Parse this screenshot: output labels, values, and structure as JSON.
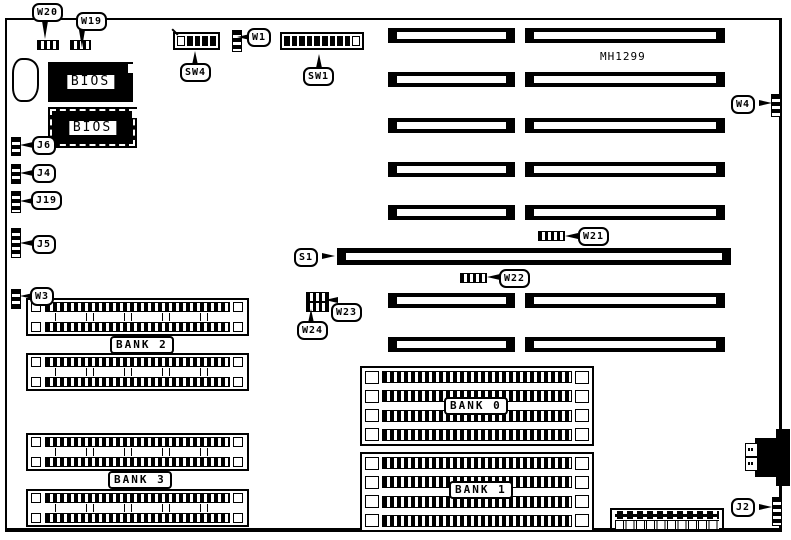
{
  "diagram": {
    "board_model": "MH1299",
    "bios_chips": [
      {
        "label": "BIOS"
      },
      {
        "label": "BIOS"
      }
    ],
    "callouts": {
      "w20": "W20",
      "w19": "W19",
      "sw4": "SW4",
      "w1": "W1",
      "sw1": "SW1",
      "w4": "W4",
      "j6": "J6",
      "j4": "J4",
      "j19": "J19",
      "j5": "J5",
      "w3": "W3",
      "s1": "S1",
      "w21": "W21",
      "w22": "W22",
      "w23": "W23",
      "w24": "W24",
      "j2": "J2"
    },
    "memory_banks": [
      {
        "label": "BANK 0",
        "sockets": 4
      },
      {
        "label": "BANK 1",
        "sockets": 4
      },
      {
        "label": "BANK 2",
        "sockets": 2
      },
      {
        "label": "BANK 3",
        "sockets": 2
      }
    ],
    "switches": [
      {
        "label": "SW1",
        "positions": 10
      },
      {
        "label": "SW4",
        "positions": 5
      }
    ],
    "expansion_slots": {
      "segmented_rows": 7,
      "long_slot_label": "S1"
    },
    "colors": {
      "ink": "#000000",
      "paper": "#ffffff"
    }
  }
}
